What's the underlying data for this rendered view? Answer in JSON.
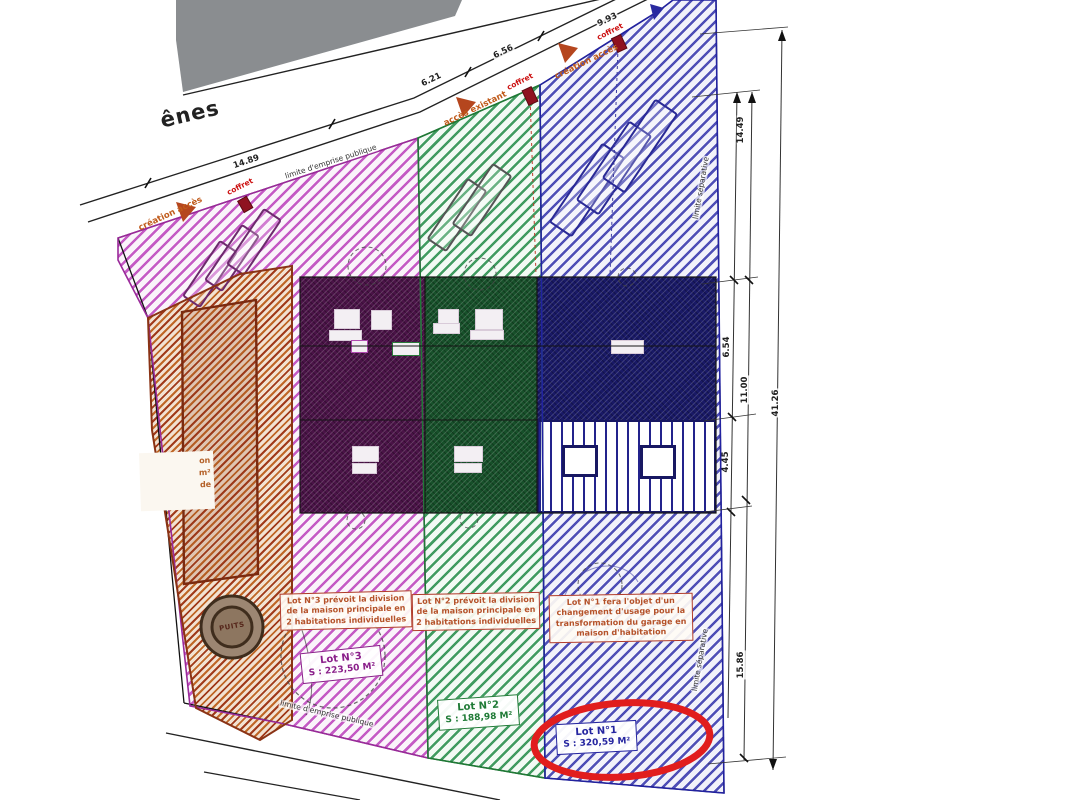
{
  "street": {
    "name": "ênes"
  },
  "top_dimensions": [
    "14.89",
    "6.21",
    "6.56",
    "9.93"
  ],
  "right_dimensions": [
    "14.49",
    "6.54",
    "11.00",
    "4.45",
    "41.26",
    "15.86"
  ],
  "boundaries": {
    "public_limit_top": "limite d'emprise publique",
    "public_limit_bottom": "limite d'emprise publique",
    "separative_limit_top": "limite séparative",
    "separative_limit_bottom": "limite séparative"
  },
  "access": {
    "created_left": "création accès",
    "existing": "accès existant",
    "created_right": "création accès"
  },
  "utilities": {
    "coffret_1": "coffret",
    "coffret_2": "coffret",
    "coffret_3": "coffret",
    "well": "PUITS"
  },
  "lots": [
    {
      "title": "Lot N°1",
      "area": "S : 320,59 M²",
      "note": "Lot N°1 fera l'objet d'un changement d'usage pour la transformation du garage en maison d'habitation",
      "color": "#2525a0"
    },
    {
      "title": "Lot N°2",
      "area": "S : 188,98 M²",
      "note": "Lot N°2 prévoit la division de la maison principale en 2 habitations individuelles",
      "color": "#1e7a35"
    },
    {
      "title": "Lot N°3",
      "area": "S : 223,50 M²",
      "note": "Lot N°3 prévoit la division de la maison principale en 2 habitations individuelles",
      "color": "#8a1f8a"
    }
  ],
  "neighbor_label": {
    "line1": "on",
    "line2": "m²",
    "line3": "de"
  },
  "highlight": {
    "type": "ellipse",
    "color": "#e11d1d",
    "target": "Lot N°1 label"
  },
  "colors": {
    "lot1_hatch": "#3c3cae",
    "lot2_hatch": "#2d9150",
    "lot3_hatch": "#bb3fbb",
    "neighbor_hatch": "#bf6626",
    "building_lot3": "#4a1347",
    "building_lot2": "#17502a",
    "building_lot1": "#191966",
    "road_marker_red": "#8f1220",
    "access_arrow": "#b5461e",
    "annotation_red": "#b03a2a",
    "neighbor_building_gray": "#8a8d90"
  }
}
